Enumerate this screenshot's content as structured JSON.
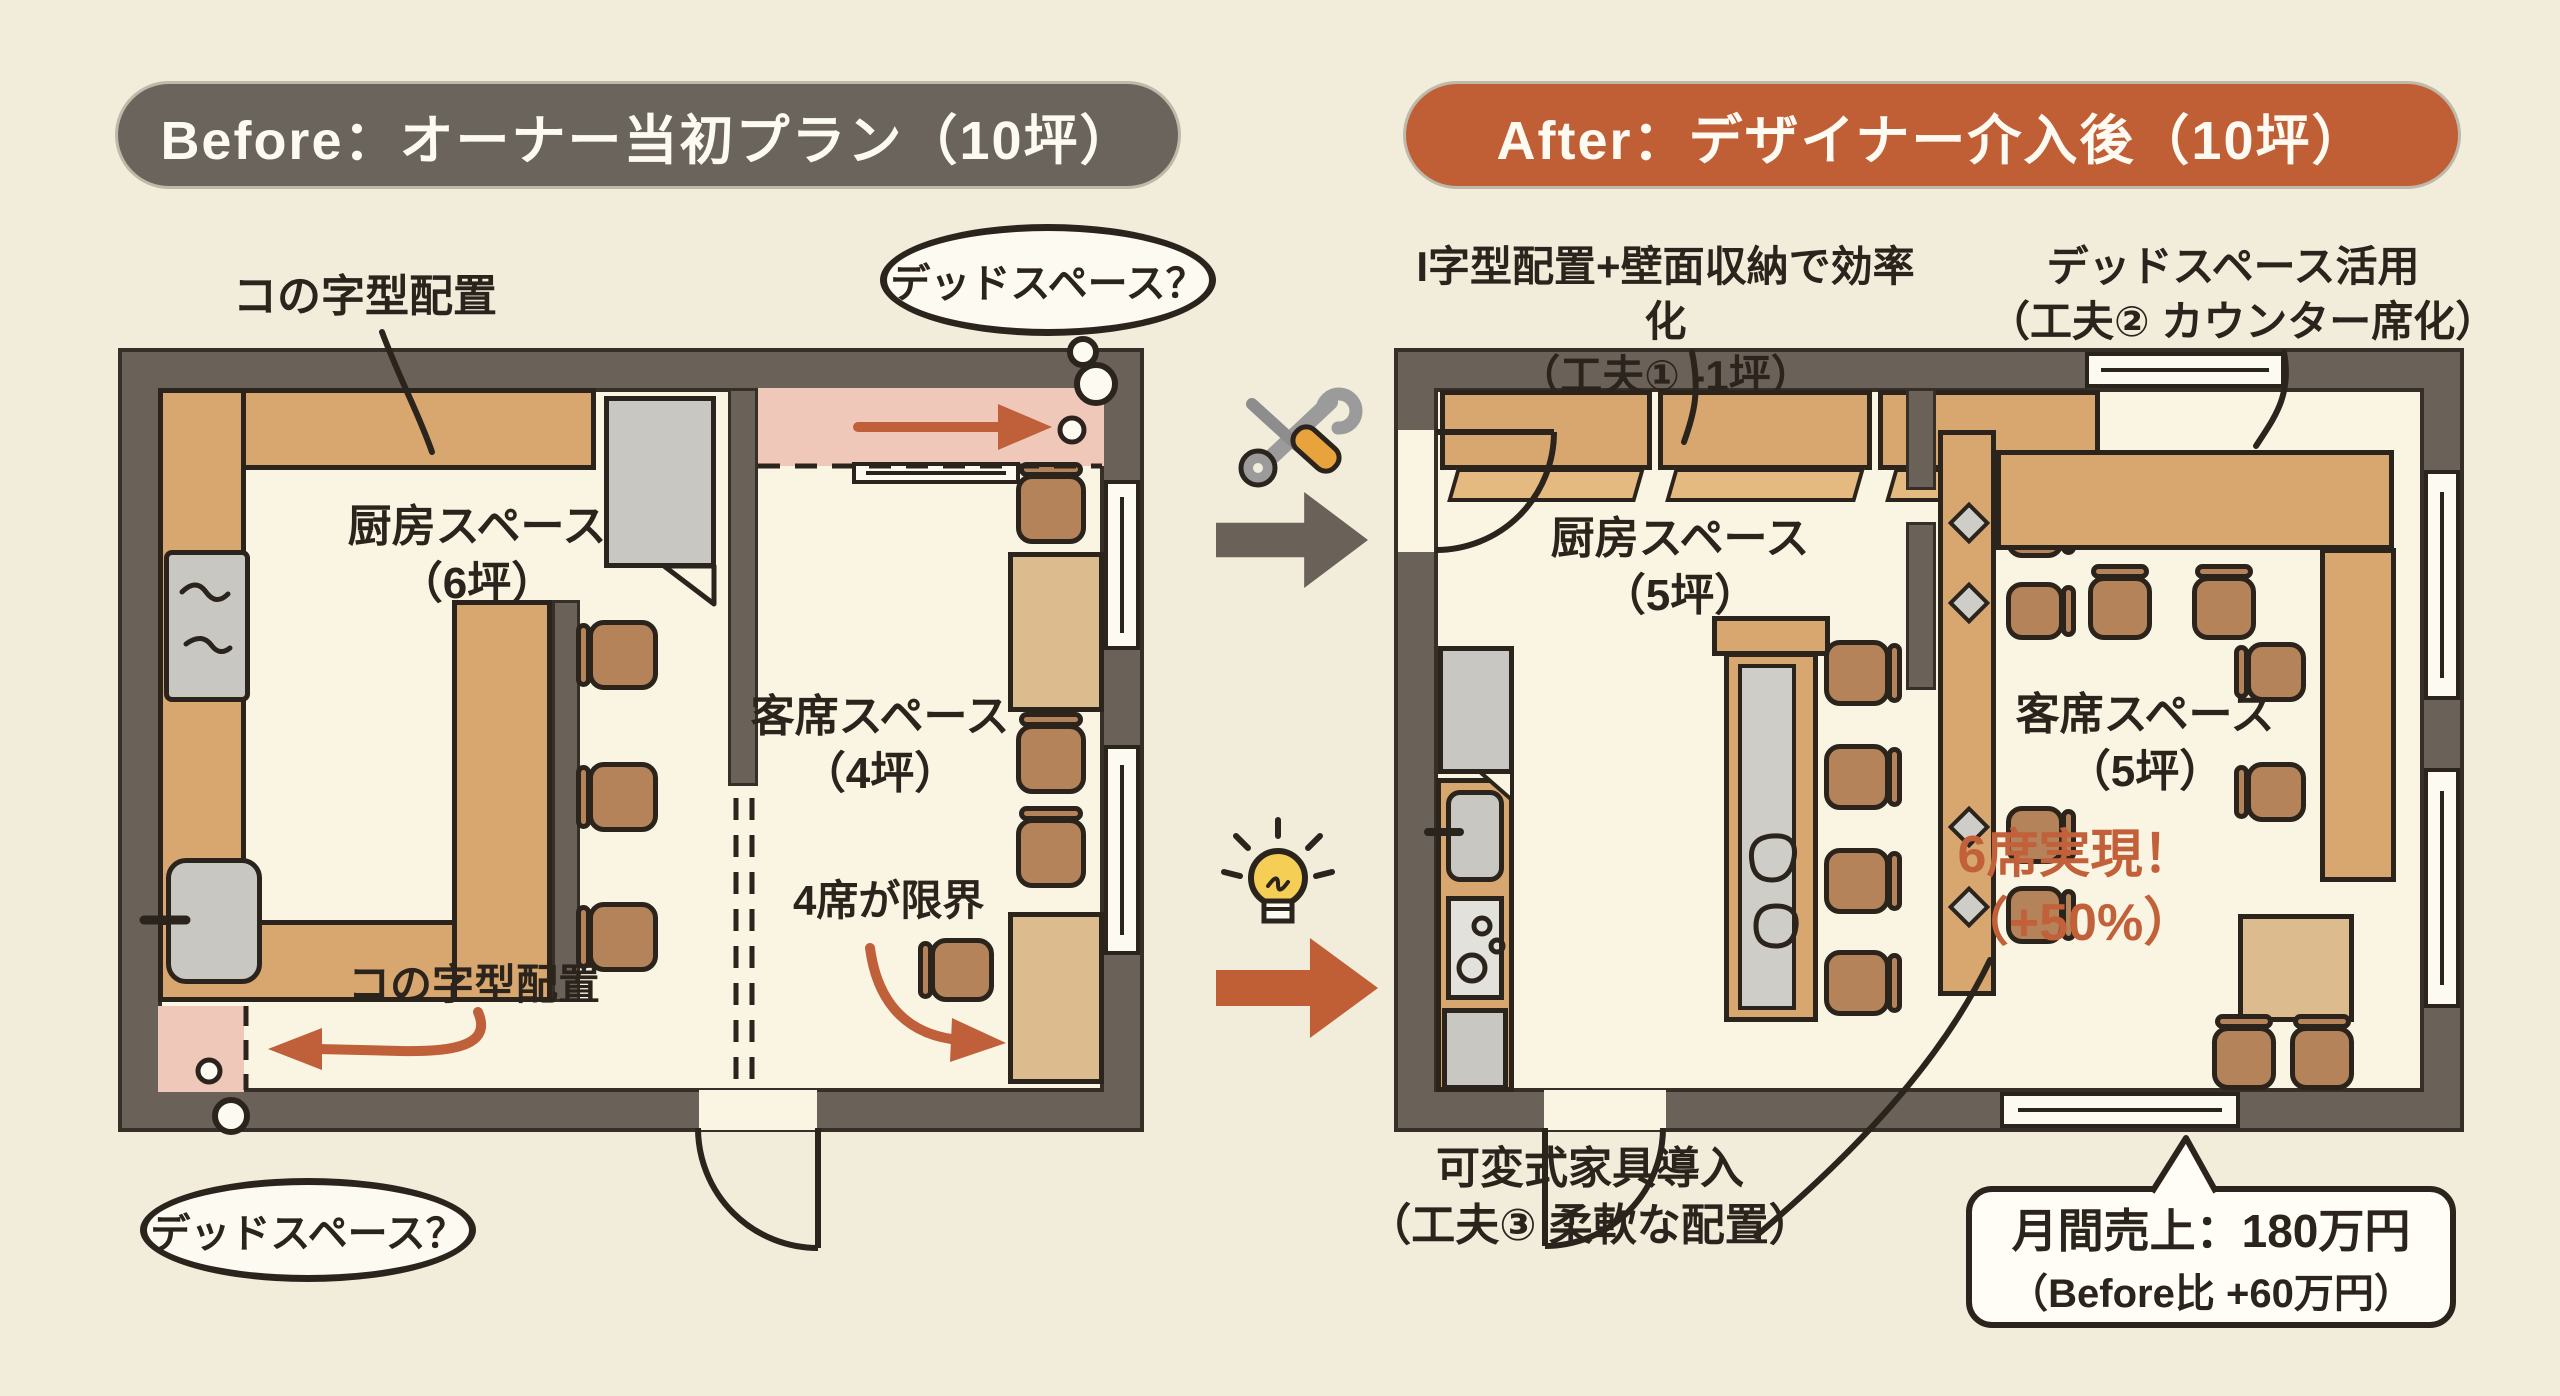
{
  "banners": {
    "before": "Before：オーナー当初プラン（10坪）",
    "after": "After：デザイナー介入後（10坪）"
  },
  "before_plan": {
    "labels": {
      "top_arrangement": "コの字型配置",
      "kitchen_line1": "厨房スペース",
      "kitchen_line2": "（6坪）",
      "dining_line1": "客席スペース",
      "dining_line2": "（4坪）",
      "seat_limit": "4席が限界",
      "bottom_arrangement": "コの字型配置",
      "dead_space_top": "デッドスペース？",
      "dead_space_bottom": "デッドスペース？"
    }
  },
  "after_plan": {
    "annotations": {
      "improvement1_line1": "I字型配置+壁面収納で効率化",
      "improvement1_line2": "（工夫① -1坪）",
      "improvement2_line1": "デッドスペース活用",
      "improvement2_line2": "（工夫② カウンター席化）",
      "improvement3_line1": "可変式家具導入",
      "improvement3_line2": "（工夫③ 柔軟な配置）"
    },
    "labels": {
      "kitchen_line1": "厨房スペース",
      "kitchen_line2": "（5坪）",
      "dining_line1": "客席スペース",
      "dining_line2": "（5坪）",
      "seats_line1": "6席実現！",
      "seats_line2": "（+50%）"
    },
    "callout": {
      "line1": "月間売上：180万円",
      "line2": "（Before比 +60万円）"
    }
  },
  "icons": {
    "tools": "crossed-wrench-screwdriver",
    "lightbulb": "idea-lightbulb",
    "gray_arrow": "right-block-arrow",
    "orange_arrow": "right-block-arrow"
  },
  "colors": {
    "background": "#f2ecdb",
    "banner_before": "#6b645c",
    "banner_after": "#c05f36",
    "wall": "#6a6159",
    "counter": "#d8a76f",
    "table": "#dcbc8e",
    "chair": "#b5835a",
    "dead_space_pink": "#f0c8ba",
    "accent_orange": "#c0603a",
    "text_dark": "#2b241d"
  }
}
